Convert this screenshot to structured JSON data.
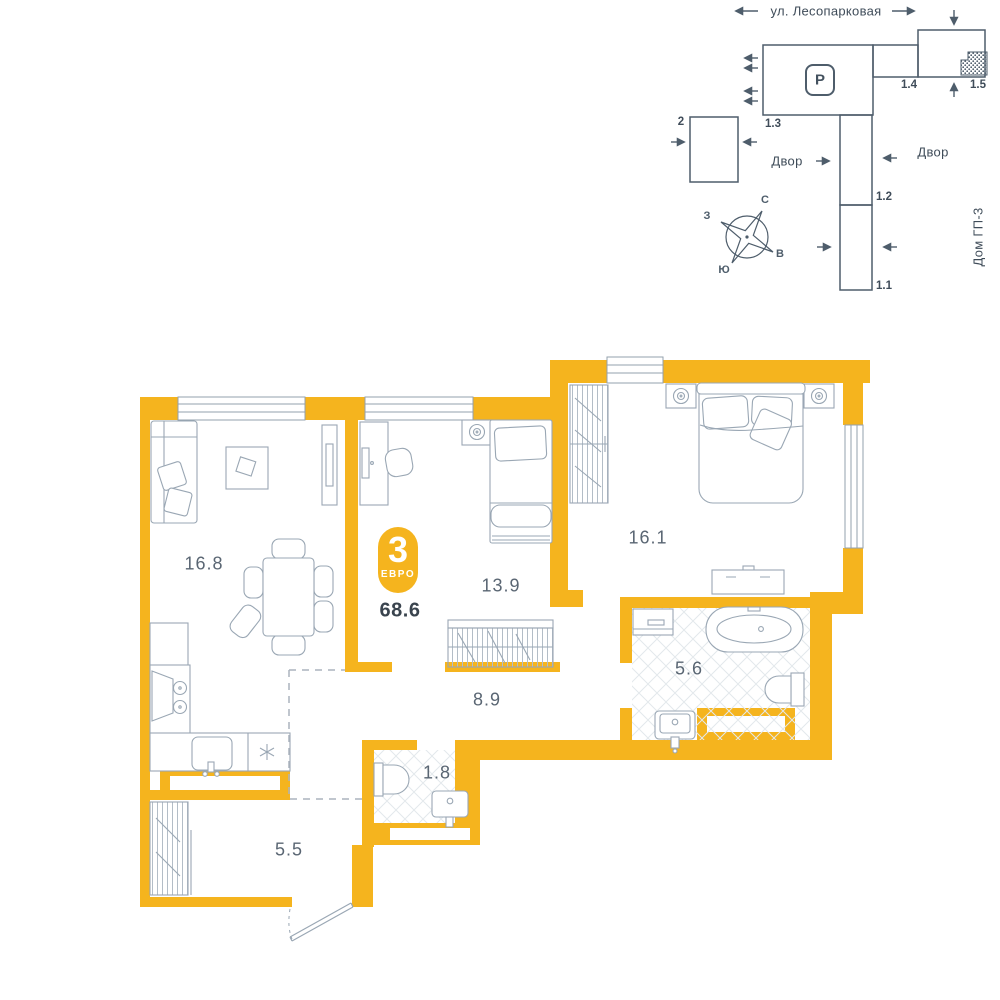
{
  "colors": {
    "wall_yellow": "#F5B41E",
    "furniture_line": "#9AA7B4",
    "tile_line": "#E3E8EC",
    "hatch_line": "#B3BDC7",
    "dash_line": "#ABB4BD",
    "site_line": "#4E5D6B",
    "label_text": "#5A6673",
    "dark_text": "#3A444E",
    "badge_text": "#FFFFFF"
  },
  "badge": {
    "rooms_count": "3",
    "type_label": "ЕВРО",
    "total_area": "68.6"
  },
  "rooms": {
    "living": {
      "area": "16.8"
    },
    "bedroom": {
      "area": "13.9"
    },
    "master": {
      "area": "16.1"
    },
    "bathroom": {
      "area": "5.6"
    },
    "hallway": {
      "area": "8.9"
    },
    "wc": {
      "area": "1.8"
    },
    "entry": {
      "area": "5.5"
    }
  },
  "site_plan": {
    "street": "ул. Лесопарковая",
    "parking": "P",
    "buildings": {
      "b2": "2",
      "b13": "1.3",
      "b14": "1.4",
      "b15": "1.5",
      "b12": "1.2",
      "b11": "1.1"
    },
    "yard_left": "Двор",
    "yard_right": "Двор",
    "house_label": "Дом ГП-3",
    "compass": {
      "north": "С",
      "south": "Ю",
      "west": "З",
      "east": "В"
    }
  }
}
